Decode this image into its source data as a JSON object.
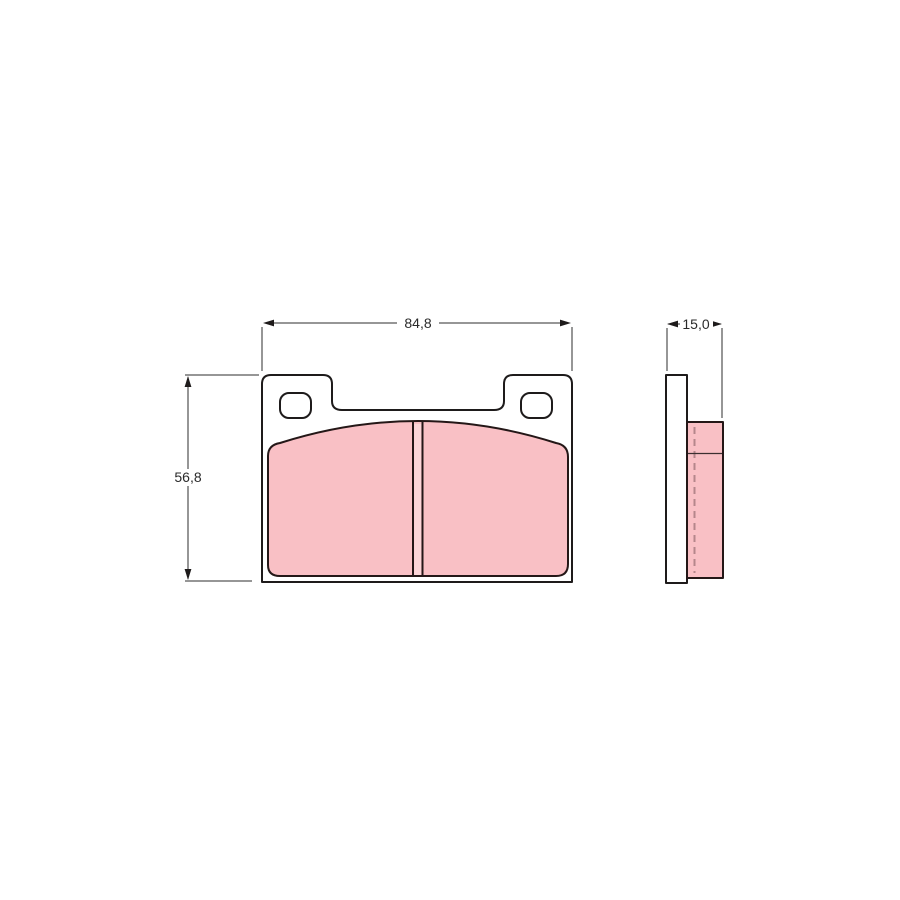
{
  "drawing": {
    "subject": "brake-pad-technical-drawing",
    "front_view": {
      "width_label": "84,8",
      "height_label": "56,8"
    },
    "side_view": {
      "thickness_label": "15,0"
    },
    "colors": {
      "friction_material": "#f9c0c5",
      "slot_fill": "#fcd5d8",
      "backing_plate": "#ffffff",
      "outline": "#1e1b1b",
      "dimension_line": "#2e2e2e",
      "hidden_line": "#b5868b",
      "background": "#ffffff"
    }
  }
}
